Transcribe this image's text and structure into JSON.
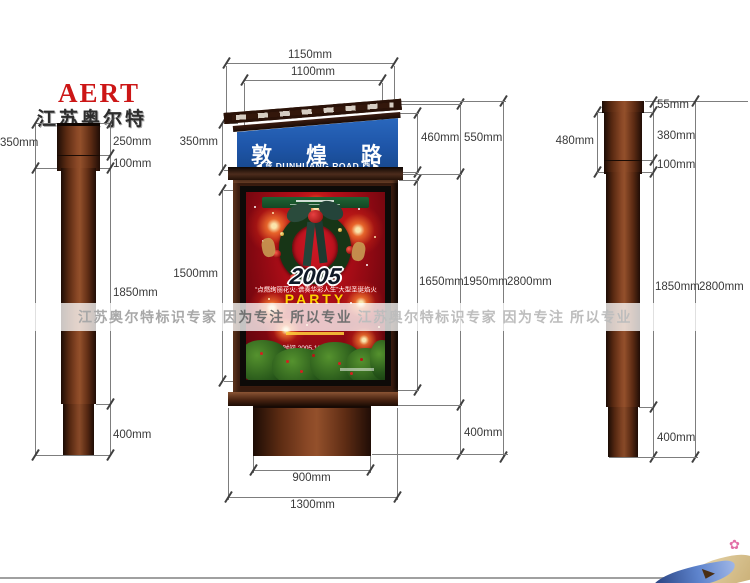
{
  "brand": {
    "logo_text": "AERT",
    "logo_cn": "江苏奥尔特"
  },
  "watermark": {
    "left": "江苏奥尔特标识专家 因",
    "emph": "为专注 所以专业",
    "right": " 江苏奥尔特标识专家 因为专注 所以专业"
  },
  "street_sign": {
    "name_cn": "敦 煌 路",
    "arrow_left": "◀",
    "dir_left": "东",
    "name_en": "DUNHUANG ROAD",
    "dir_right": "西",
    "arrow_right": "▶"
  },
  "poster": {
    "year": "2005",
    "tagline": "“点燃绚丽花火·谱奏华彩人生”大型圣诞焰火",
    "party": "PARTY",
    "date_line": "时间 2005.12.25 19:00"
  },
  "dims": {
    "left_view": {
      "overall_top": "350mm",
      "cap": "250mm",
      "collar": "100mm",
      "shaft": "1850mm",
      "base": "400mm"
    },
    "center_view": {
      "top_width": "1150mm",
      "sign_width": "1100mm",
      "sign_section": "350mm",
      "box_section": "1500mm",
      "roof_height": "460mm",
      "head_height": "550mm",
      "box_height": "1650mm",
      "body_height": "1950mm",
      "total_height": "2800mm",
      "base_height": "400mm",
      "base_width": "900mm",
      "foot_width": "1300mm"
    },
    "right_view": {
      "cap": "55mm",
      "upper": "380mm",
      "collar": "100mm",
      "head": "480mm",
      "shaft": "1850mm",
      "total": "2800mm",
      "base": "400mm"
    }
  },
  "colors": {
    "accent_red": "#cc1616",
    "sign_blue": "#1e55a8",
    "pole_brown": "#5a2c18",
    "poster_red": "#a00d18",
    "party_yellow": "#ffd200",
    "dim_text": "#3a3a3a"
  }
}
